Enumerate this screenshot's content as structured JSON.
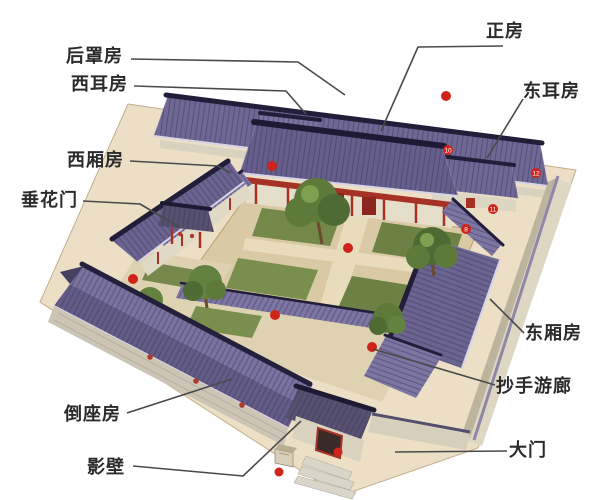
{
  "diagram": {
    "labels": {
      "hou_zhao_fang": "后罩房",
      "xi_er_fang": "西耳房",
      "xi_xiang_fang": "西厢房",
      "chui_hua_men": "垂花门",
      "zheng_fang": "正房",
      "dong_er_fang": "东耳房",
      "dong_xiang_fang": "东厢房",
      "chao_shou_you_lang": "抄手游廊",
      "dao_zuo_fang": "倒座房",
      "ying_bi": "影壁",
      "da_men": "大门"
    },
    "markers": {
      "m10": "10",
      "m11": "11",
      "m12": "12",
      "m8": "8"
    },
    "colors": {
      "roof_purple": "#6b6490",
      "ridge_dark": "#221d38",
      "wall_beige": "#e2dbc9",
      "accent_red": "#a63125",
      "marker_red": "#cf241b",
      "courtyard_green": "#74884a",
      "paving_tan": "#d9c9a5",
      "callout_line": "#4a4a4a"
    }
  }
}
